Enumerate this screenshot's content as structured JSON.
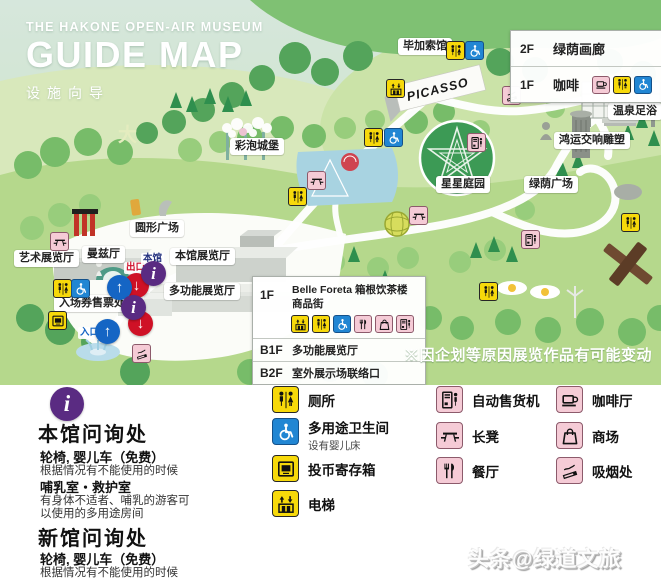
{
  "header": {
    "museum_name": "THE HAKONE OPEN-AIR MUSEUM",
    "title": "GUIDE MAP",
    "subtitle": "设施向导",
    "corner_char": "大"
  },
  "map": {
    "labels": {
      "picasso_hall": "毕加索馆",
      "picasso_building": "PICASSO",
      "foot_bath": "温泉足浴",
      "symphony_sculpture": "鸿运交响雕塑",
      "star_garden": "星星庭园",
      "green_plaza": "绿荫广场",
      "bubble_castle": "彩泡城堡",
      "circular_plaza": "圆形广场",
      "art_hall": "艺术展览厅",
      "manzu_hall": "曼兹厅",
      "main_hall": "本馆展览厅",
      "multi_hall": "多功能展览厅",
      "ticket_office": "入场券售票处",
      "entrance": "入口",
      "exit": "出口",
      "main_building": "本馆",
      "new_building": "新馆"
    },
    "gallery_box": {
      "rows": [
        {
          "floor": "2F",
          "name": "绿荫画廊"
        },
        {
          "floor": "1F",
          "name": "咖啡"
        }
      ]
    },
    "facility_box": {
      "rows": [
        {
          "floor": "1F",
          "line1": "Belle Foreta  箱根饮茶楼",
          "line2": "商品街"
        },
        {
          "floor": "B1F",
          "line1": "多功能展览厅"
        },
        {
          "floor": "B2F",
          "line1": "室外展示场联络口"
        }
      ]
    },
    "notice": "※因企划等原因展览作品有可能变动"
  },
  "legend": {
    "info_desks": [
      {
        "title": "本馆问询处",
        "lines": [
          "轮椅, 婴儿车（免费）",
          "根据情况有不能使用的时候",
          "哺乳室・救护室",
          "有身体不适者、哺乳的游客可",
          "以使用的多用途房间"
        ]
      },
      {
        "title": "新馆问询处",
        "lines": [
          "轮椅, 婴儿车（免费）",
          "根据情况有不能使用的时候"
        ]
      }
    ],
    "items": [
      {
        "label": "厕所"
      },
      {
        "label": "多用途卫生间",
        "sub": "设有婴儿床"
      },
      {
        "label": "投币寄存箱"
      },
      {
        "label": "电梯"
      },
      {
        "label": "自动售货机"
      },
      {
        "label": "长凳"
      },
      {
        "label": "餐厅"
      },
      {
        "label": "咖啡厅"
      },
      {
        "label": "商场"
      },
      {
        "label": "吸烟处"
      }
    ]
  },
  "icons": {
    "info": "i",
    "up_arrow": "↑",
    "down_arrow": "↓"
  },
  "colors": {
    "map_green": "#b5d88c",
    "badge_yellow": "#f7d90a",
    "badge_blue": "#2186d3",
    "badge_pink": "#f5cbd6",
    "marker_red": "#cf1126",
    "marker_blue": "#1565c4",
    "marker_purple": "#5a2b82"
  },
  "watermark": "头条@绿道文旅"
}
